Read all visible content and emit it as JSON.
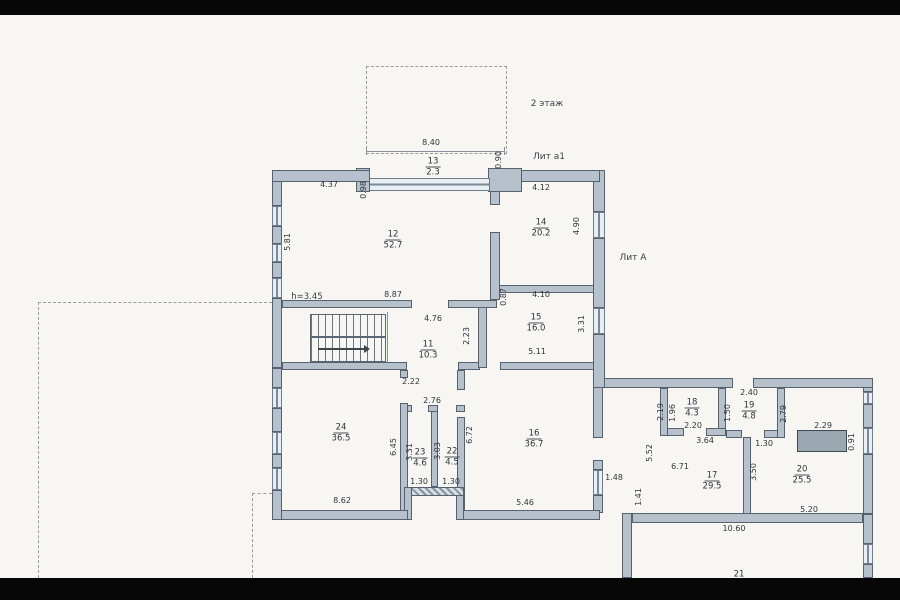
{
  "floorplan": {
    "floor_note": "2 этаж",
    "lit_a1": "Лит а1",
    "lit_a": "Лит А",
    "height_note": "h=3.45"
  },
  "rooms": [
    {
      "num": "13",
      "area": "2.3",
      "x": 433,
      "y": 163
    },
    {
      "num": "12",
      "area": "52.7",
      "x": 393,
      "y": 236
    },
    {
      "num": "14",
      "area": "20.2",
      "x": 541,
      "y": 224
    },
    {
      "num": "15",
      "area": "16.0",
      "x": 536,
      "y": 319
    },
    {
      "num": "11",
      "area": "10.3",
      "x": 428,
      "y": 346
    },
    {
      "num": "24",
      "area": "36.5",
      "x": 341,
      "y": 429
    },
    {
      "num": "23",
      "area": "4.6",
      "x": 420,
      "y": 454
    },
    {
      "num": "22",
      "area": "4.5",
      "x": 452,
      "y": 453
    },
    {
      "num": "16",
      "area": "36.7",
      "x": 534,
      "y": 435
    },
    {
      "num": "18",
      "area": "4.3",
      "x": 692,
      "y": 404
    },
    {
      "num": "19",
      "area": "4.8",
      "x": 749,
      "y": 407
    },
    {
      "num": "17",
      "area": "29.5",
      "x": 712,
      "y": 477
    },
    {
      "num": "20",
      "area": "25.5",
      "x": 802,
      "y": 471
    },
    {
      "num": "21",
      "area": "",
      "x": 739,
      "y": 571
    }
  ],
  "dims": [
    {
      "t": "8.40",
      "x": 431,
      "y": 143
    },
    {
      "t": "0.90",
      "x": 499,
      "y": 160,
      "v": true
    },
    {
      "t": "4.37",
      "x": 329,
      "y": 185
    },
    {
      "t": "0.98",
      "x": 364,
      "y": 190,
      "v": true
    },
    {
      "t": "4.12",
      "x": 541,
      "y": 188
    },
    {
      "t": "5.81",
      "x": 288,
      "y": 242,
      "v": true
    },
    {
      "t": "4.90",
      "x": 577,
      "y": 226,
      "v": true
    },
    {
      "t": "8.87",
      "x": 393,
      "y": 295
    },
    {
      "t": "0.87",
      "x": 504,
      "y": 297,
      "v": true
    },
    {
      "t": "4.10",
      "x": 541,
      "y": 295
    },
    {
      "t": "4.76",
      "x": 433,
      "y": 319
    },
    {
      "t": "2.23",
      "x": 467,
      "y": 336,
      "v": true
    },
    {
      "t": "3.31",
      "x": 582,
      "y": 324,
      "v": true
    },
    {
      "t": "5.11",
      "x": 537,
      "y": 352
    },
    {
      "t": "2.22",
      "x": 411,
      "y": 382
    },
    {
      "t": "2.76",
      "x": 432,
      "y": 401
    },
    {
      "t": "6.45",
      "x": 394,
      "y": 447,
      "v": true
    },
    {
      "t": "3.31",
      "x": 410,
      "y": 452,
      "v": true
    },
    {
      "t": "3.03",
      "x": 438,
      "y": 451,
      "v": true
    },
    {
      "t": "1.30",
      "x": 419,
      "y": 482
    },
    {
      "t": "1.30",
      "x": 451,
      "y": 482
    },
    {
      "t": "8.62",
      "x": 342,
      "y": 501
    },
    {
      "t": "6.72",
      "x": 470,
      "y": 435,
      "v": true
    },
    {
      "t": "5.46",
      "x": 525,
      "y": 503
    },
    {
      "t": "1.48",
      "x": 614,
      "y": 478
    },
    {
      "t": "2.19",
      "x": 661,
      "y": 412,
      "v": true
    },
    {
      "t": "1.96",
      "x": 673,
      "y": 413,
      "v": true
    },
    {
      "t": "2.20",
      "x": 693,
      "y": 426
    },
    {
      "t": "2.40",
      "x": 749,
      "y": 393
    },
    {
      "t": "1.50",
      "x": 728,
      "y": 413,
      "v": true
    },
    {
      "t": "2.79",
      "x": 784,
      "y": 414,
      "v": true
    },
    {
      "t": "3.64",
      "x": 705,
      "y": 441
    },
    {
      "t": "1.30",
      "x": 764,
      "y": 444
    },
    {
      "t": "2.29",
      "x": 823,
      "y": 426
    },
    {
      "t": "0.91",
      "x": 852,
      "y": 442,
      "v": true
    },
    {
      "t": "5.52",
      "x": 650,
      "y": 453,
      "v": true
    },
    {
      "t": "6.71",
      "x": 680,
      "y": 467
    },
    {
      "t": "3.50",
      "x": 754,
      "y": 472,
      "v": true
    },
    {
      "t": "1.41",
      "x": 639,
      "y": 497,
      "v": true
    },
    {
      "t": "5.20",
      "x": 809,
      "y": 510
    },
    {
      "t": "10.60",
      "x": 734,
      "y": 529
    }
  ],
  "colors": {
    "paper": "#f7f6f3",
    "wall_fill": "#b6c1cb",
    "wall_edge": "#55626e",
    "window_fill": "#e8eef3",
    "cabinet_fill": "#9aa6b0"
  }
}
